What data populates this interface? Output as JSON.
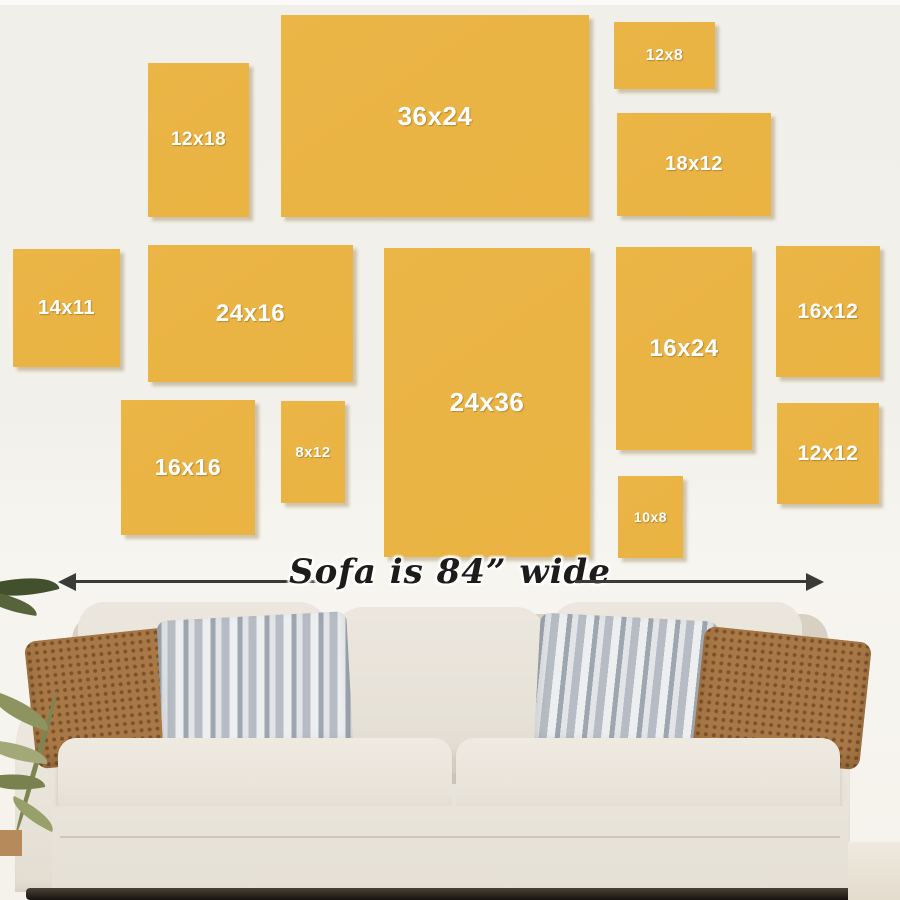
{
  "title": "Canvas size guide above sofa",
  "frames": [
    {
      "label": "12x18",
      "x": 148,
      "y": 63,
      "w": 101,
      "h": 154,
      "fs": 19
    },
    {
      "label": "36x24",
      "x": 281,
      "y": 15,
      "w": 308,
      "h": 202,
      "fs": 26
    },
    {
      "label": "12x8",
      "x": 614,
      "y": 22,
      "w": 101,
      "h": 67,
      "fs": 16
    },
    {
      "label": "18x12",
      "x": 617,
      "y": 113,
      "w": 154,
      "h": 103,
      "fs": 20
    },
    {
      "label": "14x11",
      "x": 13,
      "y": 249,
      "w": 107,
      "h": 118,
      "fs": 20
    },
    {
      "label": "24x16",
      "x": 148,
      "y": 245,
      "w": 205,
      "h": 137,
      "fs": 24
    },
    {
      "label": "24x36",
      "x": 384,
      "y": 248,
      "w": 206,
      "h": 309,
      "fs": 26
    },
    {
      "label": "16x24",
      "x": 616,
      "y": 247,
      "w": 136,
      "h": 203,
      "fs": 24
    },
    {
      "label": "16x12",
      "x": 776,
      "y": 246,
      "w": 104,
      "h": 131,
      "fs": 21
    },
    {
      "label": "16x16",
      "x": 121,
      "y": 400,
      "w": 134,
      "h": 135,
      "fs": 23
    },
    {
      "label": "8x12",
      "x": 281,
      "y": 401,
      "w": 64,
      "h": 102,
      "fs": 15
    },
    {
      "label": "10x8",
      "x": 618,
      "y": 476,
      "w": 65,
      "h": 82,
      "fs": 14
    },
    {
      "label": "12x12",
      "x": 777,
      "y": 403,
      "w": 102,
      "h": 101,
      "fs": 21
    }
  ],
  "measure": {
    "note": "Sofa is 84” wide"
  },
  "colors": {
    "canvas_yellow": "#ebb547",
    "canvas_label_text": "#ffffff",
    "wall_background": "#f1efe9",
    "note_text": "#1d1c1a",
    "arrow": "#3a3a38",
    "sofa_fabric": "#e9e4da",
    "pillow_brown": "#a87947",
    "pillow_gray": "#ccd0d5"
  }
}
